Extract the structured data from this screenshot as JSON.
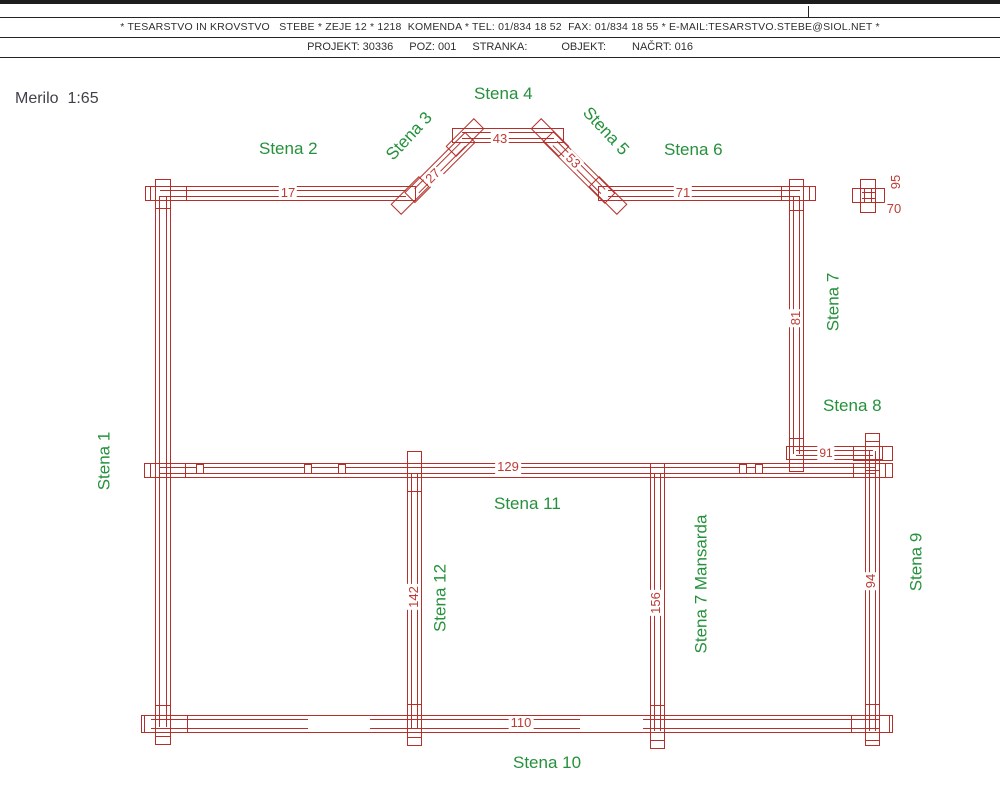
{
  "header": {
    "line1": "* TESARSTVO IN KROVSTVO   STEBE * ZEJE 12 * 1218  KOMENDA * TEL: 01/834 18 52  FAX: 01/834 18 55 * E-MAIL:TESARSTVO.STEBE@SIOL.NET *",
    "fields": {
      "projekt": "PROJEKT: 30336",
      "poz": "POZ: 001",
      "stranka": "STRANKA:",
      "objekt": "OBJEKT:",
      "nacrt": "NAČRT: 016"
    }
  },
  "scale": "Merilo  1:65",
  "colors": {
    "wall_red": "#b5302b",
    "dim_red": "#bf3a33",
    "label_green": "#25913c"
  },
  "labels": {
    "stena1": "Stena 1",
    "stena2": "Stena 2",
    "stena3": "Stena 3",
    "stena4": "Stena 4",
    "stena5": "Stena 5",
    "stena6": "Stena 6",
    "stena7": "Stena 7",
    "stena8": "Stena 8",
    "stena9": "Stena 9",
    "stena10": "Stena 10",
    "stena11": "Stena 11",
    "stena12": "Stena 12",
    "stena7_mansarda": "Stena 7 Mansarda"
  },
  "dims": {
    "d17": "17",
    "d27": "27",
    "d43": "43",
    "d53": "53",
    "d71": "71",
    "d95": "95",
    "d70": "70",
    "d81": "81",
    "d91": "91",
    "d129": "129",
    "d142": "142",
    "d156": "156",
    "d94": "94",
    "d110": "110"
  }
}
